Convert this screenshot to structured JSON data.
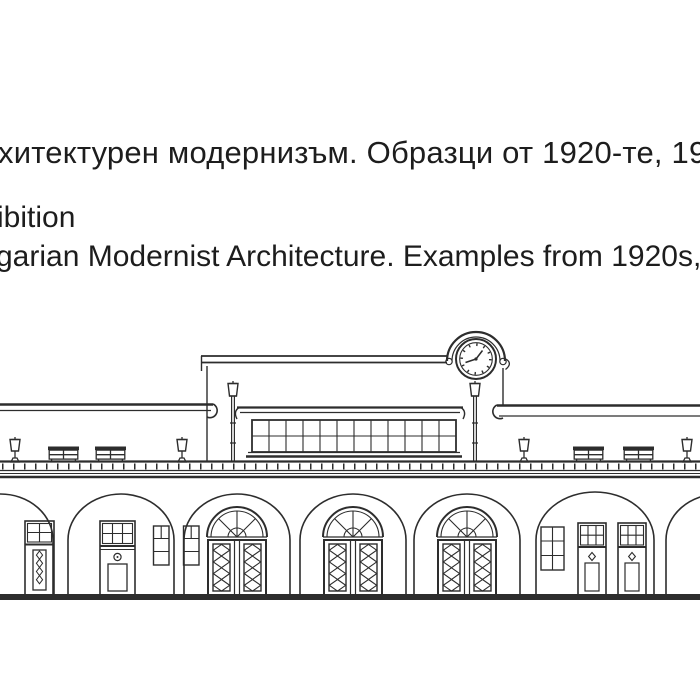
{
  "page": {
    "background_color": "#ffffff",
    "text_color": "#1d1d1d",
    "ink_color": "#2d2d2d"
  },
  "caption": {
    "line1": "хитектурен модернизъм. Образци от 1920-те, 1930",
    "line2": "ibition",
    "line3": "garian Modernist Architecture. Examples from 1920s,"
  },
  "drawing": {
    "subject": "Line-art front elevation of a modernist railway-station building, cropped at left and right edges",
    "elements": [
      "rooftop clock inside semicircular pediment with volutes",
      "flat parapet roof on tall central block",
      "clerestory window band (2 rows of panes)",
      "left and right wing flat roofs",
      "2 tall platform lamp posts",
      "4 short platform lamps",
      "4 slatted benches",
      "platform edge band with tick marks",
      "7 round-arched arcade openings",
      "3 fanlight double doors with diamond-lattice leaves",
      "single doors with gridded transoms",
      "small stacked stair windows",
      "thick ground line"
    ]
  }
}
